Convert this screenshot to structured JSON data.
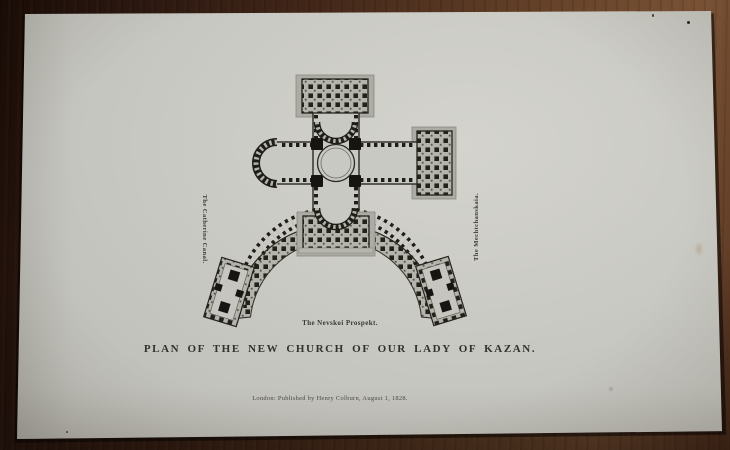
{
  "plate": {
    "title": "PLAN OF THE NEW CHURCH OF OUR LADY OF KAZAN.",
    "street_labels": {
      "left_vertical": "The Catherine Canal.",
      "right_vertical": "The Mechtchanskaia.",
      "bottom": "The Nevskoi Prospekt."
    },
    "imprint": "London: Published by Henry Colburn, August 1, 1828."
  },
  "colors": {
    "paper": "#c9c9c3",
    "ink": "#32312b",
    "engraving_gray": "#b2b1a9",
    "wood_dark": "#190c06",
    "wood_light": "#7a5336"
  }
}
